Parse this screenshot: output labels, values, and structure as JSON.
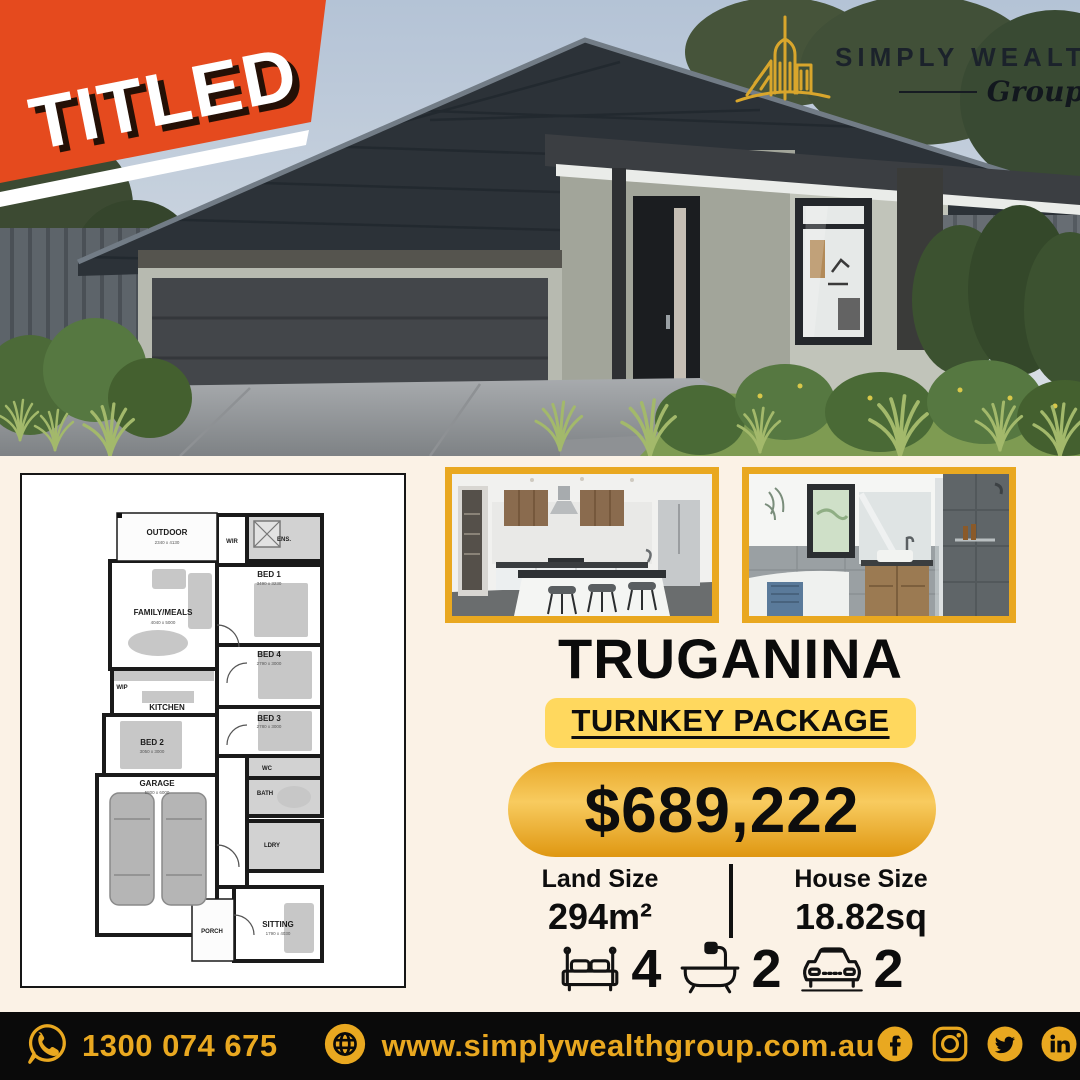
{
  "badge": {
    "label": "TITLED"
  },
  "logo": {
    "name": "SIMPLY WEALTH",
    "reg": "®",
    "sub": "Group"
  },
  "images": {
    "house": "house-exterior-photo",
    "kitchen": "kitchen-photo",
    "bathroom": "bathroom-photo",
    "floorplan": "floor-plan"
  },
  "floorplan": {
    "rooms": [
      {
        "name": "OUTDOOR",
        "dims": "2340 x 4130"
      },
      {
        "name": "WIR",
        "dims": ""
      },
      {
        "name": "ENS.",
        "dims": ""
      },
      {
        "name": "BED 1",
        "dims": "3490 x 3230"
      },
      {
        "name": "FAMILY/MEALS",
        "dims": "4040 x 5000"
      },
      {
        "name": "BED 4",
        "dims": "2790 x 3000"
      },
      {
        "name": "KITCHEN",
        "dims": ""
      },
      {
        "name": "WIP",
        "dims": ""
      },
      {
        "name": "BED 3",
        "dims": "2780 x 3000"
      },
      {
        "name": "BED 2",
        "dims": "3050 x 3000"
      },
      {
        "name": "GARAGE",
        "dims": "5800 x 6000"
      },
      {
        "name": "WC",
        "dims": ""
      },
      {
        "name": "BATH",
        "dims": ""
      },
      {
        "name": "LDRY",
        "dims": ""
      },
      {
        "name": "SITTING",
        "dims": "1790 x 4030"
      },
      {
        "name": "PORCH",
        "dims": ""
      }
    ]
  },
  "listing": {
    "suburb": "TRUGANINA",
    "package_label": "TURNKEY PACKAGE",
    "price": "$689,222",
    "land": {
      "label": "Land Size",
      "value": "294m²"
    },
    "house": {
      "label": "House Size",
      "value": "18.82sq"
    },
    "features": [
      {
        "icon": "bed-icon",
        "value": "4"
      },
      {
        "icon": "bath-icon",
        "value": "2"
      },
      {
        "icon": "car-icon",
        "value": "2"
      }
    ]
  },
  "footer": {
    "phone": "1300 074 675",
    "website": "www.simplywealthgroup.com.au",
    "icons": [
      "whatsapp-icon",
      "globe-icon",
      "facebook-icon",
      "instagram-icon",
      "twitter-icon",
      "linkedin-icon"
    ]
  },
  "colors": {
    "accent_gold": "#e9a820",
    "highlight_yellow": "#ffd85e",
    "badge_red": "#e54a1e",
    "cream_bg": "#fbf2e6",
    "footer_black": "#0a0a0a"
  }
}
